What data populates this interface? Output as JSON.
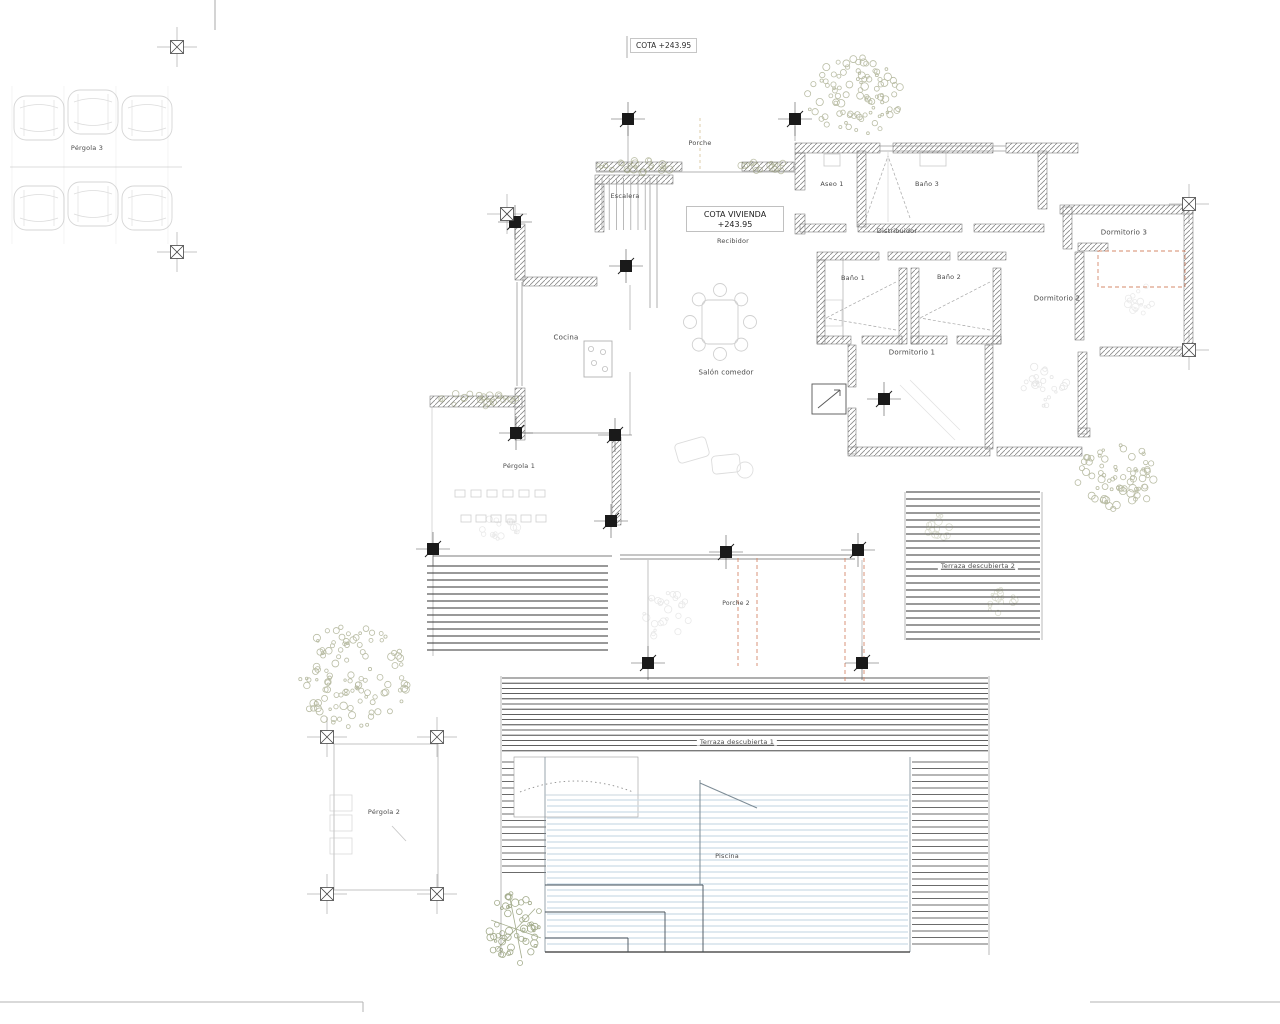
{
  "title": {
    "text": "COTA +243.95"
  },
  "cota_box": {
    "line1": "COTA VIVIENDA",
    "line2": "+243.95"
  },
  "labels": {
    "porche": "Porche",
    "escalera": "Escalera",
    "recibidor": "Recibidor",
    "aseo1": "Aseo 1",
    "bano3": "Baño 3",
    "distribuidor": "Distribuidor",
    "dormitorio3": "Dormitorio 3",
    "bano1": "Baño 1",
    "bano2": "Baño 2",
    "dormitorio2": "Dormitorio 2",
    "dormitorio1": "Dormitorio 1",
    "cocina": "Cocina",
    "salon": "Salón comedor",
    "pergola1": "Pérgola 1",
    "pergola2": "Pérgola 2",
    "pergola3": "Pérgola 3",
    "terraza1": "Terraza descubierta 1",
    "terraza2": "Terraza descubierta 2",
    "piscina": "Piscina",
    "porche2": "Porche 2"
  },
  "colors": {
    "wall_hatch": "#8a8a8a",
    "wall_edge": "#666666",
    "line_dark": "#333333",
    "accent_dashed": "#d4886a",
    "tree_green": "#8b9168",
    "palm_green": "#7e8a5d",
    "pool_stripe": "#ccdce8",
    "faint_gray": "#bdbdbd"
  }
}
